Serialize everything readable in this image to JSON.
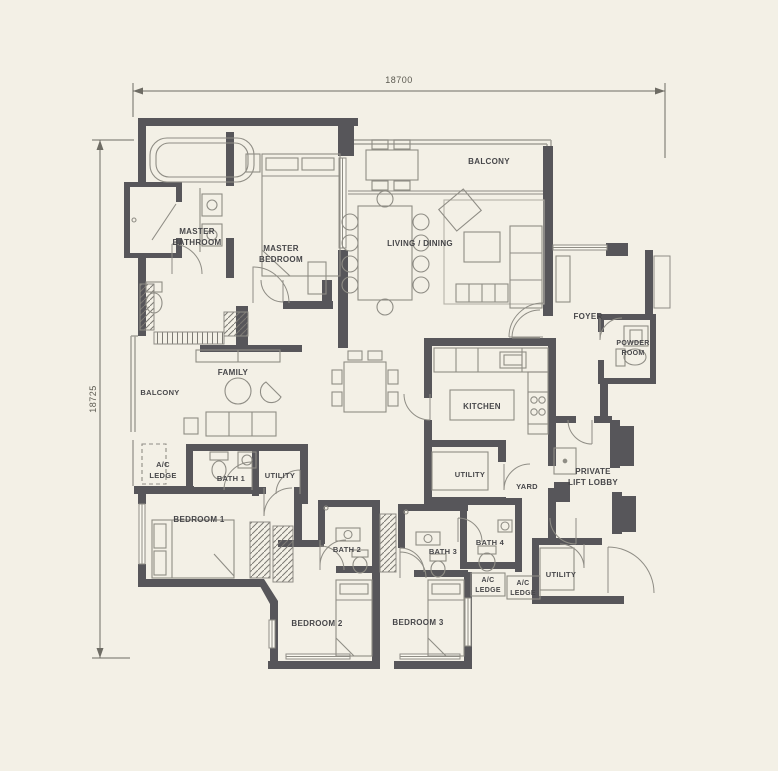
{
  "dimensions": {
    "width_label": "18700",
    "height_label": "18725"
  },
  "labels": {
    "balcony_top": "BALCONY",
    "master_bathroom_l1": "MASTER",
    "master_bathroom_l2": "BATHROOM",
    "master_bedroom_l1": "MASTER",
    "master_bedroom_l2": "BEDROOM",
    "living_dining": "LIVING / DINING",
    "foyer": "FOYER",
    "powder_room_l1": "POWDER",
    "powder_room_l2": "ROOM",
    "family": "FAMILY",
    "balcony_left": "BALCONY",
    "kitchen": "KITCHEN",
    "ac_ledge_left_l1": "A/C",
    "ac_ledge_left_l2": "LEDGE",
    "bath1": "BATH 1",
    "utility_family": "UTILITY",
    "utility_kitchen": "UTILITY",
    "yard": "YARD",
    "lift_lobby_l1": "PRIVATE",
    "lift_lobby_l2": "LIFT LOBBY",
    "bedroom1": "BEDROOM 1",
    "bath2": "BATH 2",
    "bath3": "BATH 3",
    "bath4": "BATH 4",
    "ac_ledge_mid1_l1": "A/C",
    "ac_ledge_mid1_l2": "LEDGE",
    "ac_ledge_mid2_l1": "A/C",
    "ac_ledge_mid2_l2": "LEDGE",
    "utility_lobby": "UTILITY",
    "bedroom2": "BEDROOM 2",
    "bedroom3": "BEDROOM 3"
  },
  "colors": {
    "background": "#f3f0e6",
    "wall": "#57565a",
    "furniture_line": "#8f8d85",
    "railing": "#a3a199",
    "text": "#47474a",
    "dimension_line": "#6e6c64"
  }
}
